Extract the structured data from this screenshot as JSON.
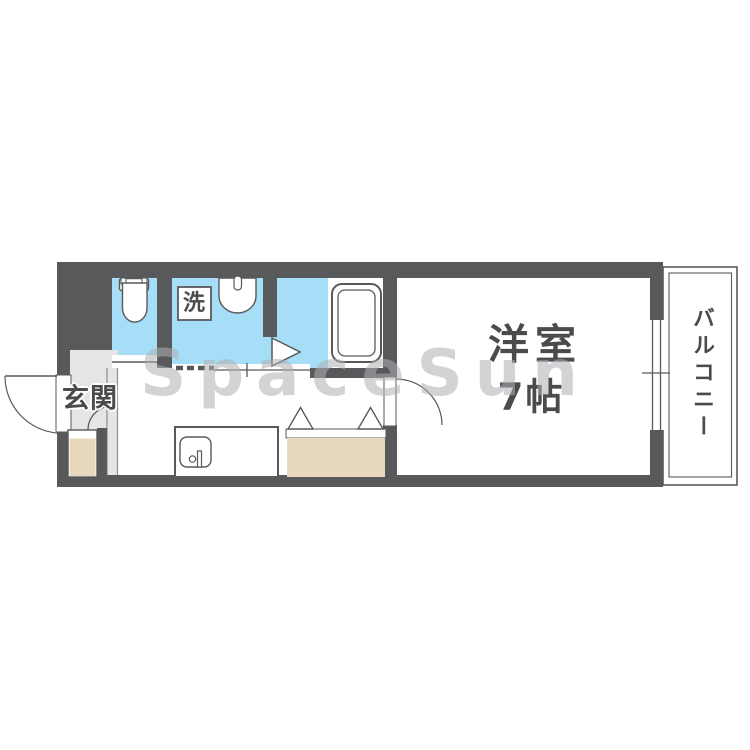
{
  "plan": {
    "labels": {
      "entrance": "玄関",
      "washer": "洗",
      "room_name": "洋室",
      "room_size": "7帖",
      "balcony": "バルコニー"
    },
    "watermark": "SpaceSun",
    "colors": {
      "wall": "#58595b",
      "wet_area_floor": "#a6ddf7",
      "storage_fill": "#e8d8bd",
      "entrance_floor": "#e5e5e6",
      "label_text": "#4a4b4d",
      "background": "#ffffff"
    }
  }
}
